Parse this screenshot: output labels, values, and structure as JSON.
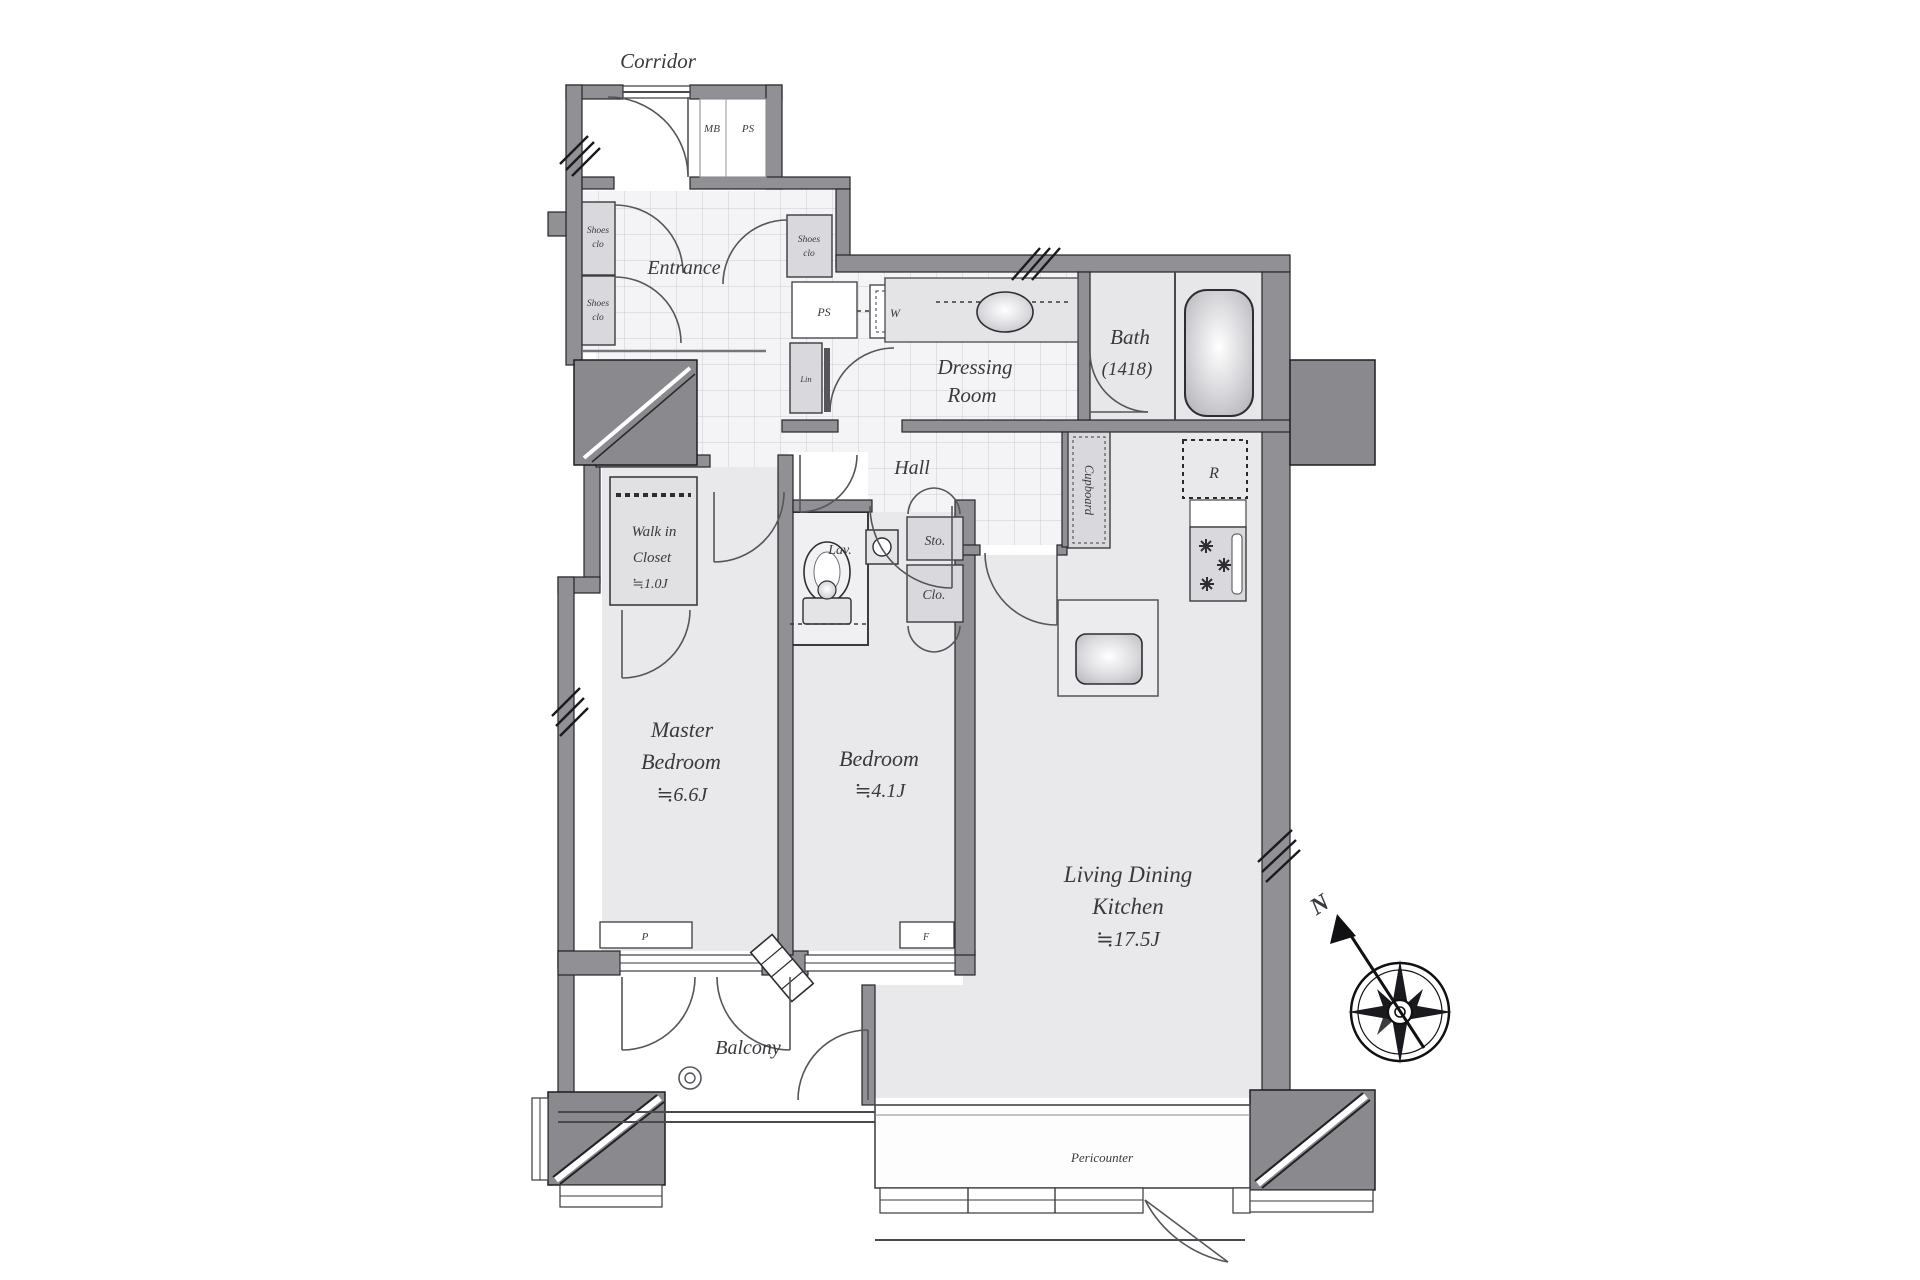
{
  "colors": {
    "wall": "#919195",
    "pillar": "#8a8a8e",
    "floor": "#e9e9ec",
    "tile_bg": "#f4f4f6",
    "tile_line": "#cbcbd0",
    "cabinet": "#d9d9dd",
    "counter": "#e4e4e7",
    "text": "#3a3a3e"
  },
  "rooms": {
    "corridor": {
      "label": "Corridor"
    },
    "entrance": {
      "label": "Entrance"
    },
    "hall": {
      "label": "Hall"
    },
    "dressing_room": {
      "line1": "Dressing",
      "line2": "Room"
    },
    "bath": {
      "label": "Bath",
      "size": "(1418)"
    },
    "lavatory": {
      "label": "Lav."
    },
    "walk_in_closet": {
      "line1": "Walk in",
      "line2": "Closet",
      "size": "≒1.0J"
    },
    "master_bedroom": {
      "line1": "Master",
      "line2": "Bedroom",
      "size": "≒6.6J"
    },
    "bedroom": {
      "label": "Bedroom",
      "size": "≒4.1J"
    },
    "ldk": {
      "line1": "Living Dining",
      "line2": "Kitchen",
      "size": "≒17.5J"
    },
    "balcony": {
      "label": "Balcony"
    }
  },
  "fixtures": {
    "shoes_closet_a": {
      "line1": "Shoes",
      "line2": "clo"
    },
    "shoes_closet_b": {
      "line1": "Shoes",
      "line2": "clo"
    },
    "shoes_closet_c": {
      "line1": "Shoes",
      "line2": "clo"
    },
    "meter_box": "MB",
    "pipe_shaft_top": "PS",
    "pipe_shaft": "PS",
    "washing_machine": "W",
    "linen": "Lin",
    "cupboard": "Cupboard",
    "refrigerator": "R",
    "storage": "Sto.",
    "closet": "Clo.",
    "pipe_space": "P",
    "fixture_f": "F",
    "pericounter": "Pericounter"
  },
  "compass": {
    "north": "N"
  }
}
